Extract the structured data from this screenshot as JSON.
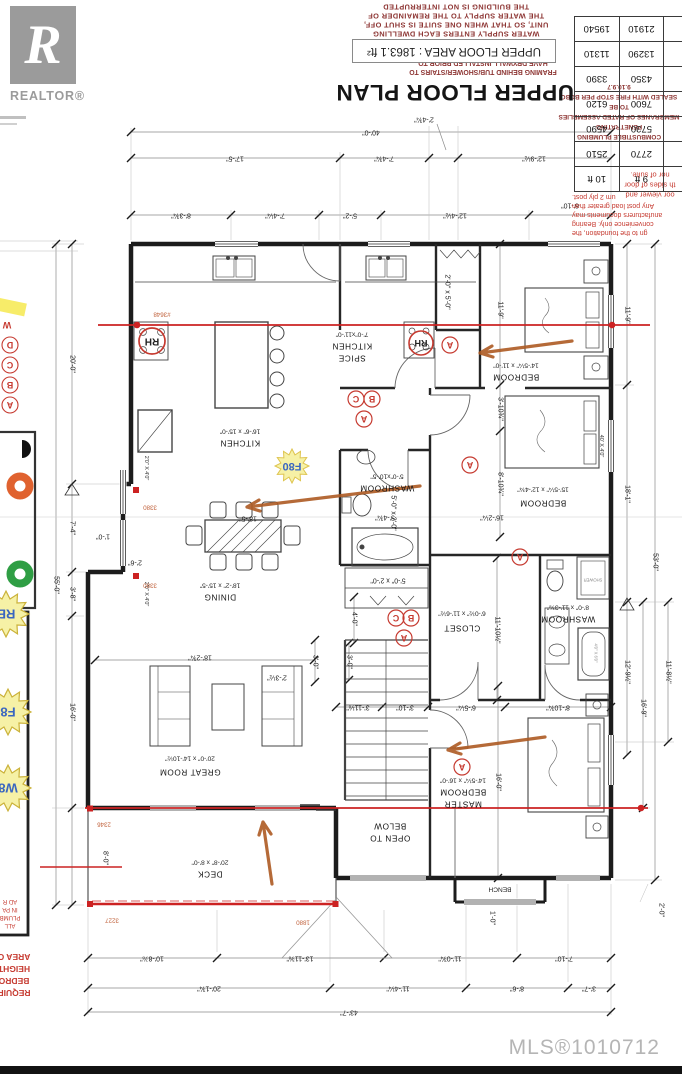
{
  "branding": {
    "logo_text": "REALTOR®",
    "mls": "MLS®1010712"
  },
  "header": {
    "title": "UPPER FLOOR PLAN",
    "area_box": "UPPER FLOOR AREA : 1863.1 ft²",
    "notes_combustible": [
      "COMBUSTIBLE PLUMBING PENETRATING",
      "MEMBRANES OF RATED ASSEMBLIES TO BE",
      "SEALED WITH FIRE STOP PER BCBC 9.10.9.7"
    ],
    "notes_framing": [
      "FRAMING BEHIND TUB/SHOWER/STAIRS TO",
      "HAVE DRYWALL INSTALLED PRIOR TO",
      "FIXTURE/STAIR INSTALLATION."
    ],
    "notes_shutoffs": [
      "SHUT-OFFS SHALL BE INSTALLED WHERE THE",
      "WATER SUPPLY ENTERS EACH DWELLING",
      "UNIT, SO THAT WHEN ONE SUITE IS SHUT OFF,",
      "THE WATER SUPPLY TO THE REMAINDER OF",
      "THE BUILDING IS NOT INTERRUPTED"
    ]
  },
  "post_table": {
    "rows": [
      [
        "9 ft",
        "10 ft"
      ],
      [
        "2770",
        "2510"
      ],
      [
        "5730",
        "4590"
      ],
      [
        "7600",
        "6120"
      ],
      [
        "4350",
        "3390"
      ],
      [
        "13290",
        "11310"
      ],
      [
        "21910",
        "19540"
      ]
    ],
    "notes": [
      "gn to the foundation, the",
      "convenience only. Bearing",
      "anufacturers documents may",
      "Any post load greater than",
      "um 2 ply post."
    ]
  },
  "door_note": [
    "oor viewer and",
    "th sides of door",
    "nor of suite."
  ],
  "rooms": {
    "kitchen": {
      "name": "KITCHEN",
      "dims": "16'-6\" x 15'-0\""
    },
    "spice": {
      "name1": "SPICE",
      "name2": "KITCHEN",
      "dims": "7'-0\"x11'-0\""
    },
    "dining": {
      "name": "DINING",
      "dims": "18'-2\" x 15'-5\""
    },
    "great": {
      "name": "GREAT ROOM",
      "dims": "20'-0\" x 14'-10½\""
    },
    "bedroom1": {
      "name": "BEDROOM",
      "dims": "14'-5¼\" x 11'-0\""
    },
    "bedroom2": {
      "name": "BEDROOM",
      "dims": "15'-5¼\" x 12'-4¾\""
    },
    "washroom_mid": {
      "name": "WASHROOM",
      "dims": "5'-0\"x10'-5\""
    },
    "washroom_right": {
      "name": "WASHROOM",
      "dims": "8'-0\" x 11'-3⅜\""
    },
    "closet": {
      "name": "CLOSET",
      "dims": "6'-0½\" x 11'-6½\""
    },
    "master": {
      "name1": "MASTER",
      "name2": "BEDROOM",
      "dims": "14'-5¼\" x 16'-0\""
    },
    "open_below": {
      "line1": "OPEN TO",
      "line2": "BELOW"
    },
    "deck": {
      "name": "DECK",
      "dims": "20'-8\" x 8'-0\""
    },
    "bench": "BENCH",
    "shower": "SHOWER"
  },
  "dims": {
    "top1": "40'-0\"",
    "top1_leader": "2'-4¾\"",
    "top2": [
      "17'-5\"",
      "7'-4¾\"",
      "12'-9½\""
    ],
    "top3": [
      "8'-3¾\"",
      "7'-4¼\"",
      "5'-2\"",
      "12'-4½\"",
      "6'-10\""
    ],
    "left": [
      "20'-0\"",
      "7'-4\"",
      "3'-8\"",
      "16'-0\"",
      "8'-0\"",
      "55'-0\""
    ],
    "right": [
      "11'-9\"",
      "18'-1\"",
      "12'-9½\"",
      "53'-0\"",
      "11'-8½\"",
      "16'-9\"",
      "2'-0\""
    ],
    "bottom1": [
      "10'-8⅞\"",
      "13'-11⅜\"",
      "11'-0¾\"",
      "7'-10\""
    ],
    "bottom2": [
      "20'-1¾\"",
      "11'-4¼\"",
      "8'-6\"",
      "3'-7\""
    ],
    "bottom3": "43'-7\"",
    "interior": {
      "v11_9": "11'-9\"",
      "v3_10": "3'-10¾\"",
      "v8_10a": "8'-10¾\"",
      "h16_2": "16'-2¼\"",
      "h5_4": "5'-4¾\"",
      "v11_10": "11'-10½\"",
      "v4_0": "4'-0\"",
      "v3_0a": "3'-0\"",
      "v3_0b": "3'-0\"",
      "v16_0": "16'-0\"",
      "h18_5": "18'-5\"",
      "h18_2": "18'-2¾\"",
      "h2_3": "2'-3½\"",
      "h1_0": "1'-0\"",
      "h2_6": "2'-6\"",
      "h3_11": "3'-11⅛\"",
      "h3_10": "3'-10\"",
      "h6_5": "6'-5¼\"",
      "h8_10b": "8'-10¾\"",
      "c5x2a": "5'-0\" x 2'-0\"",
      "c5x2b": "5'-0\" x 2'-0\"",
      "c2x5": "2'-0\" x 5'-0\"",
      "v1_0": "1'-0\""
    },
    "windows": {
      "w2040": "2'0\" X 4'0\"",
      "w4040": "40' X 4'0\"",
      "tub": "4'0\" X 6'0\""
    }
  },
  "red_numbers": {
    "n3648": "#3648",
    "n3380": "3380",
    "n2346": "2346",
    "n3227": "3227",
    "n1880": "1880"
  },
  "stamps": {
    "rh": "RH",
    "f80": "F80",
    "s1": "RB",
    "s2": "F8",
    "s3": "W8",
    "w_frag": "W"
  },
  "letters": {
    "a": "A",
    "b": "B",
    "c": "C",
    "d": "D"
  },
  "left_notes": {
    "block1": [
      "ALL",
      "PLUMB",
      "IN PA",
      "AD R"
    ],
    "block2": [
      "REQUIR",
      "BEDRO",
      "HEIGHT",
      "AREA O"
    ]
  }
}
